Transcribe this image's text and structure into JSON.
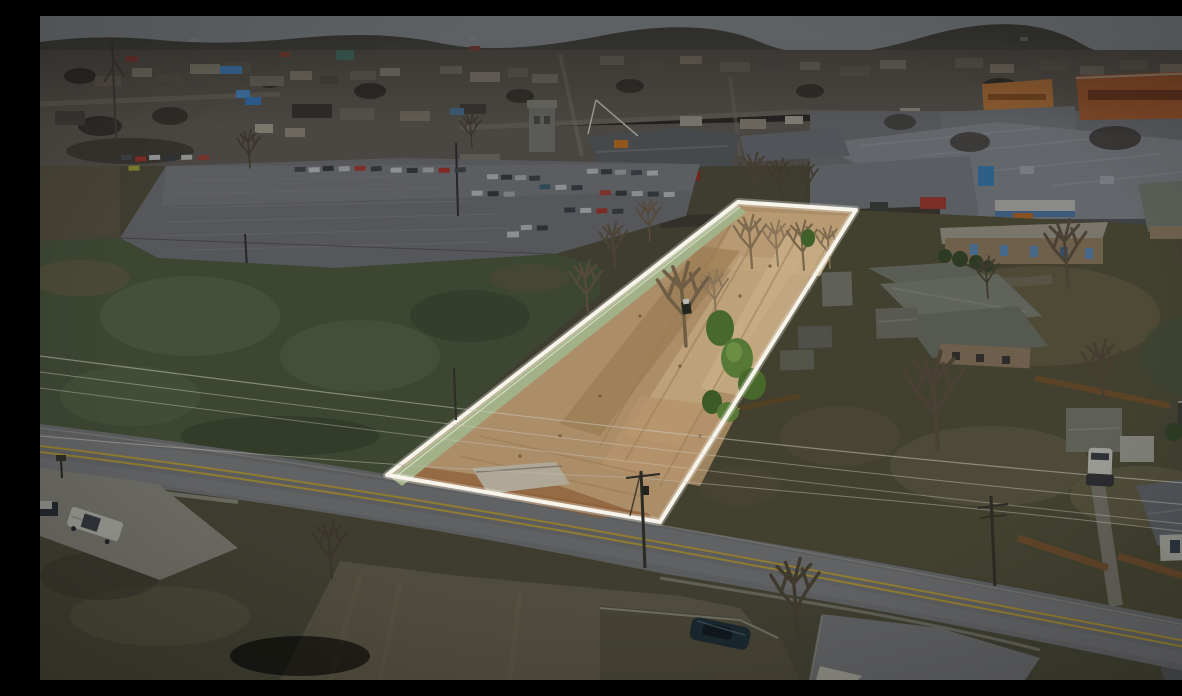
{
  "image": {
    "type": "aerial-drone-photograph",
    "subject": "Vacant cleared land parcel highlighted with a white boundary outline; surrounding town is dimmed",
    "width_px": 1182,
    "height_px": 664,
    "boundary": {
      "shape": "quadrilateral",
      "points": "698,186 816,194 620,506 347,459",
      "stroke_width": 4
    },
    "colors": {
      "highlight-border": "#f7f4ec",
      "lot-dirt": "#ab8d68",
      "lot-dirt-light": "#c9ad85",
      "lot-dirt-dark": "#8f734f",
      "lot-green-strip": "#a3b188",
      "sky": "#7e8287",
      "town-base": "#4a4641",
      "field-green": "#3c4631",
      "asphalt": "#5b5c5e",
      "road-line-yellow": "#8f7c30",
      "residential-ground": "#42402f",
      "dry-grass": "#534e3a",
      "warehouse-roof": "#63666a",
      "orange-building": "#7c4627",
      "evergreen": "#3c5a28",
      "leafy-green": "#5d8040",
      "concrete": "#6b6a63",
      "white-vehicle": "#95968f",
      "dark-vehicle": "#1a272e",
      "fence-wood": "#5f4529"
    },
    "landmarks": [
      "cleared tan-dirt lot with bare trees and a small skid-steer loader",
      "large parking lot with rows of parked cars to the north-west",
      "dense small-town commercial strip along the horizon",
      "gray warehouse rooftops and an orange commercial building to the north-east",
      "residential houses, sheds and wooden privacy fences to the east",
      "two-lane road with double yellow centre line crossing the foreground",
      "dark green field to the west",
      "white pickup truck in a concrete driveway at lower left",
      "dark car parked on a grass island at bottom centre",
      "utility poles with overhead power lines crossing the parcel"
    ]
  }
}
